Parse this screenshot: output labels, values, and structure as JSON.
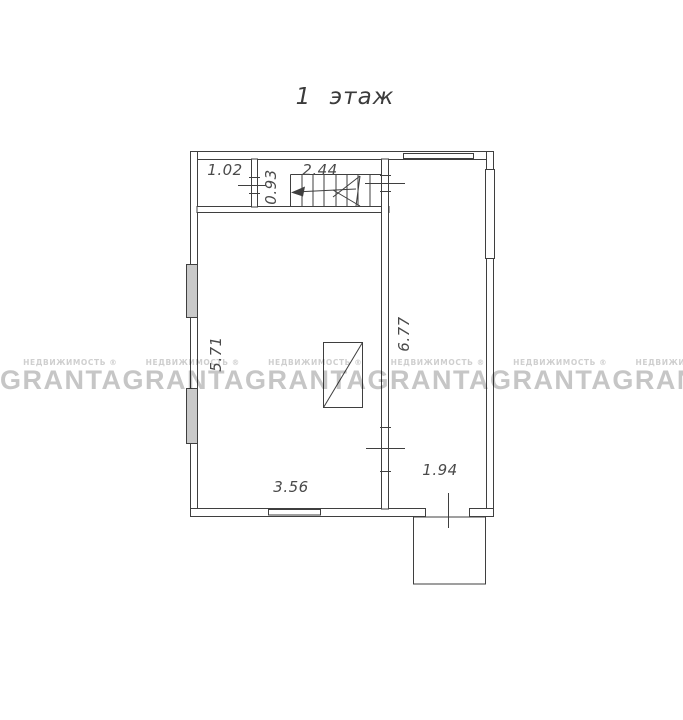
{
  "title": "1 этаж",
  "watermark": {
    "brand": "GRANTA",
    "subtitle": "НЕДВИЖИМОСТЬ ®",
    "brand_color": "#c6c6c6",
    "repeat_count": 6
  },
  "dimensions": {
    "entry_room_width": "1.02",
    "stair_corridor_width": "0.93",
    "stair_length": "2.44",
    "living_room_depth": "5.71",
    "hall_depth": "6.77",
    "living_room_width": "3.56",
    "hall_width": "1.94"
  },
  "colors": {
    "plan_lines": "#3f3f3f",
    "label_text": "#4a4a4a",
    "window_fill": "#c9c9c9"
  }
}
